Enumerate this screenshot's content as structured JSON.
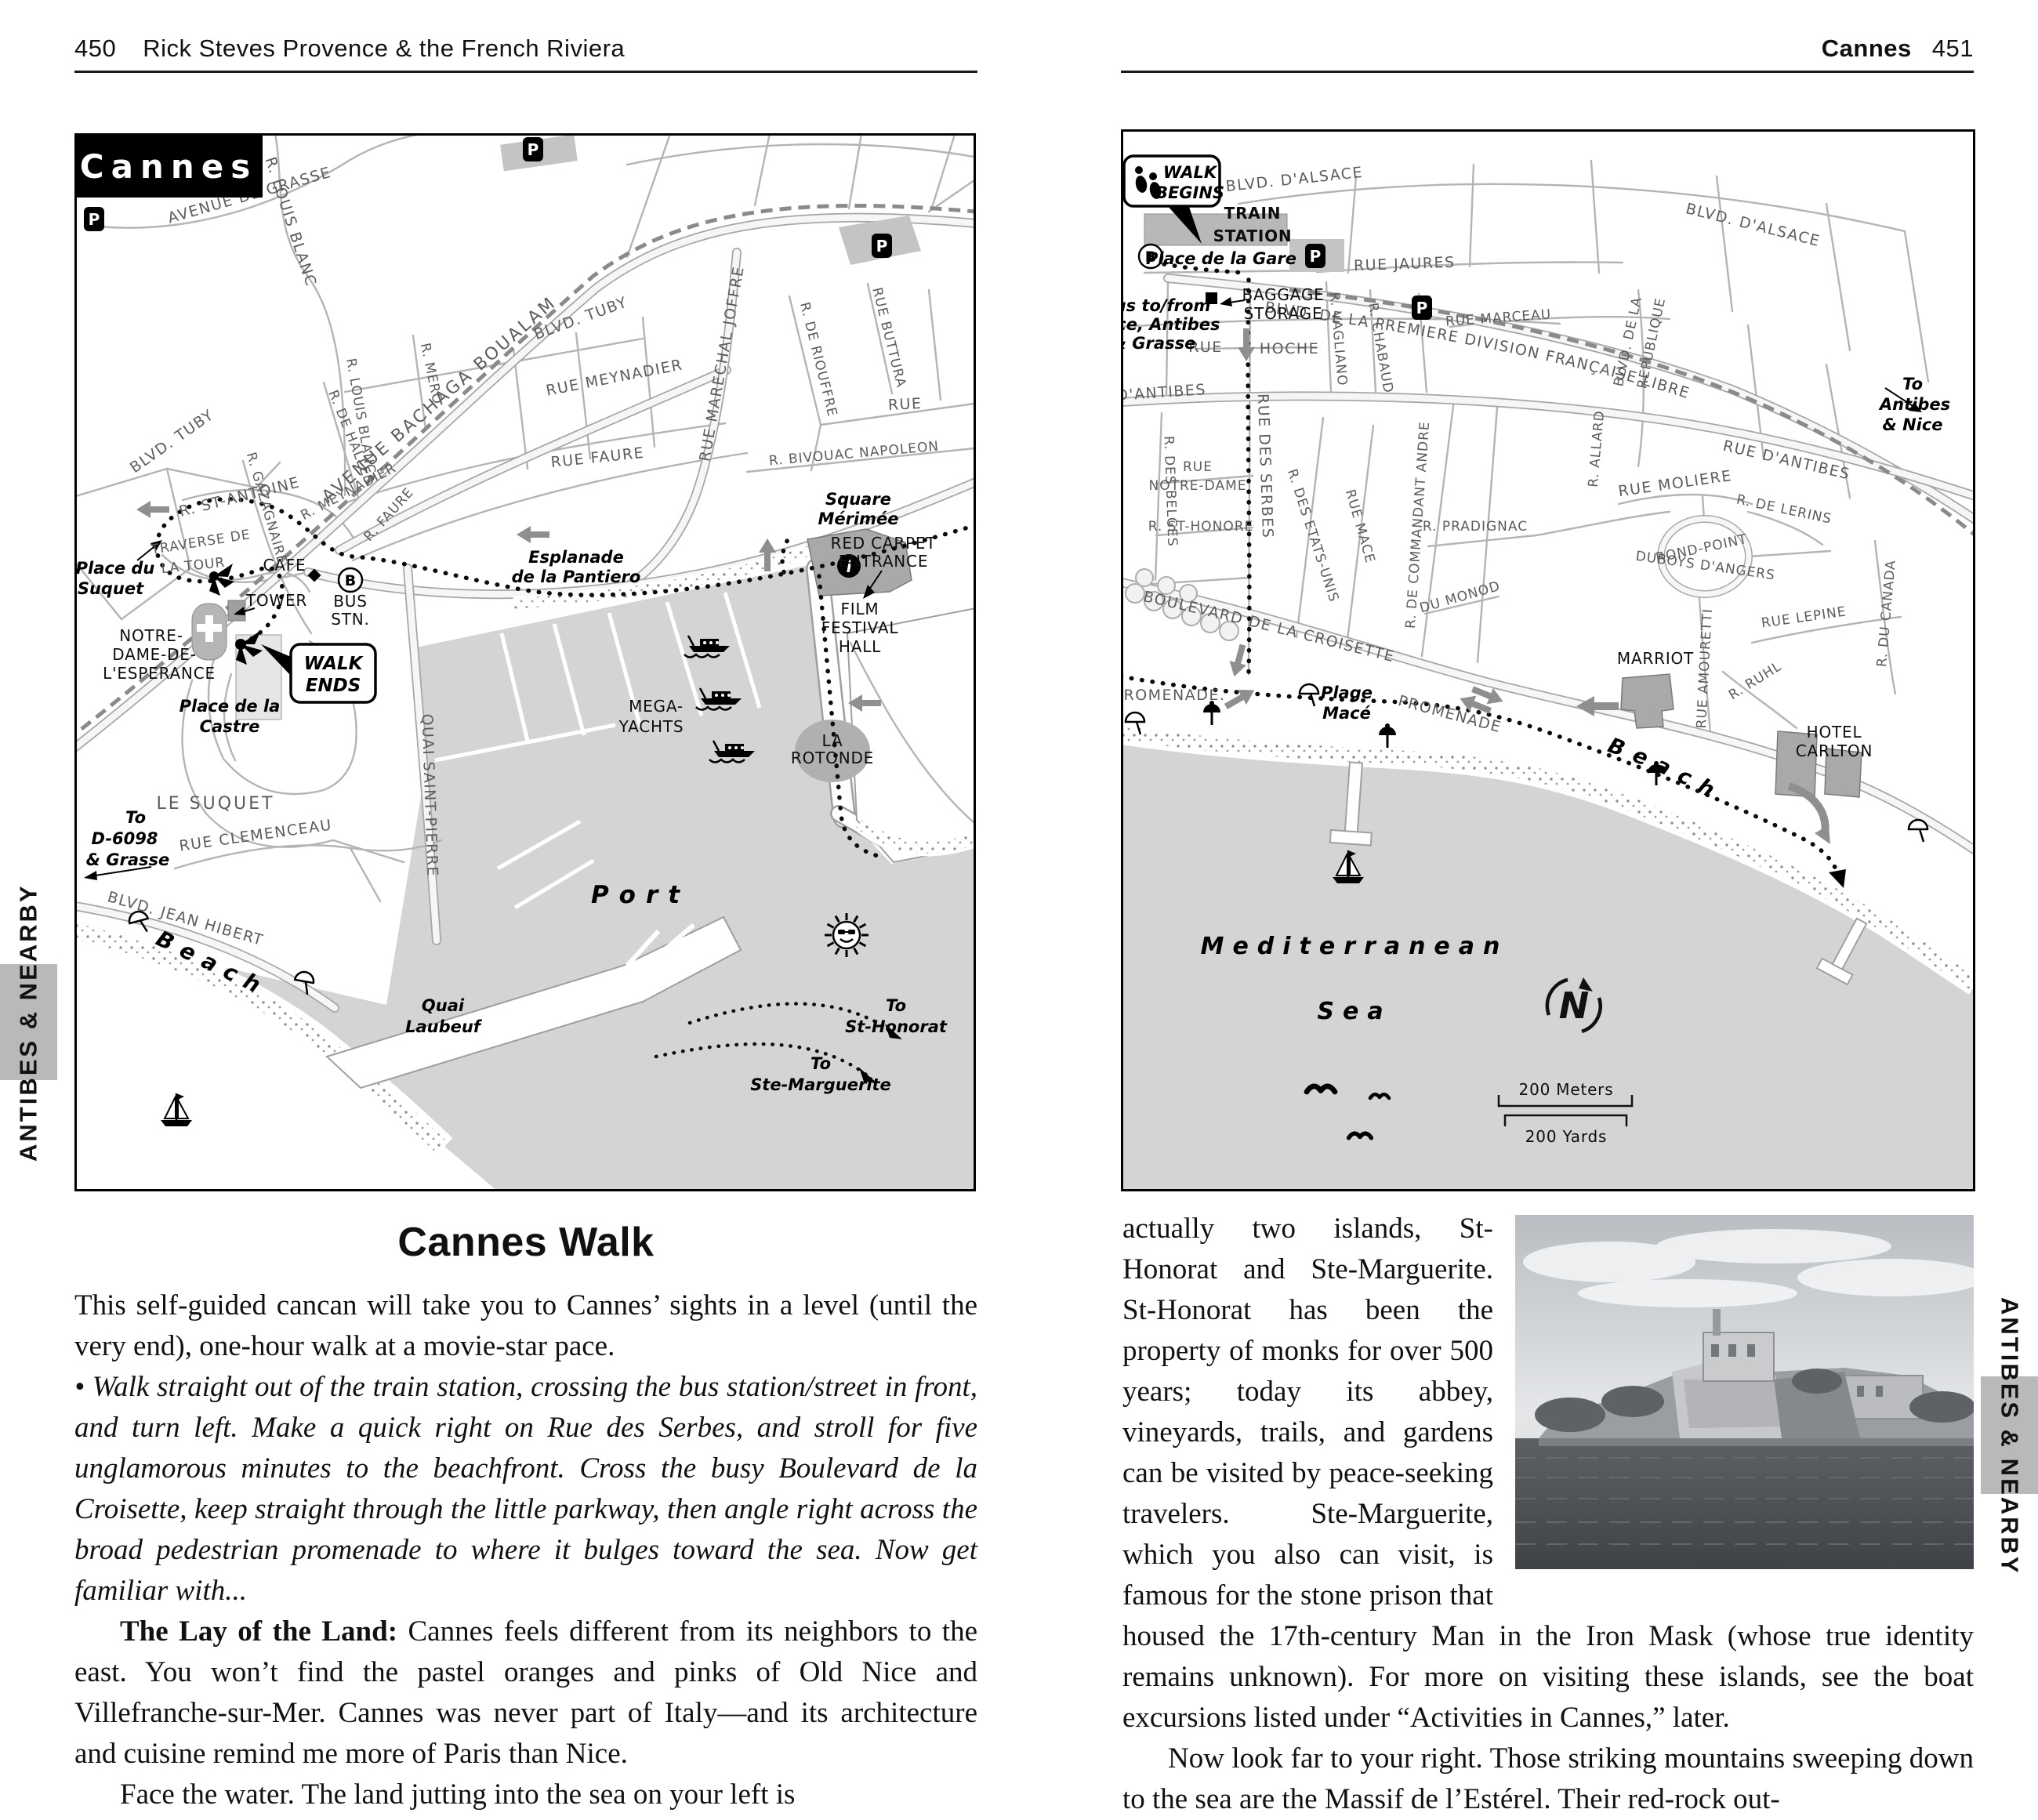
{
  "header_left": {
    "page_number": "450",
    "title": "Rick Steves Provence & the French Riviera"
  },
  "header_right": {
    "title": "Cannes",
    "page_number": "451"
  },
  "edge_tab": {
    "label": "ANTIBES & NEARBY"
  },
  "icons": {
    "parking": "P",
    "bus_stop": "B",
    "information": "i",
    "compass_north": "N"
  },
  "left_map": {
    "title": "Cannes",
    "streets": {
      "louis_blanc_upper": "R. LOUIS BLANC",
      "avenue_de_grasse": "AVENUE DE GRASSE",
      "avenue_bachaga": "AVENUE BACHAGA BOUALAM",
      "blvd_tuby_right": "BLVD. TUBY",
      "blvd_tuby_left": "BLVD. TUBY",
      "r_de_halles": "R. DE HALLES",
      "r_mero": "R. MERO",
      "rue_meynadier": "RUE MEYNADIER",
      "r_meynadier": "R. MEYNADIER",
      "r_gazagnaire": "R. GAZAGNAIRE",
      "louis_blanc_lower": "R. LOUIS BLANC",
      "rue_faure": "RUE FAURE",
      "r_faure": "R. FAURE",
      "rue_marechal_joffre": "RUE MARECHAL JOFFRE",
      "r_de_riouffre": "R. DE RIOUFFRE",
      "rue_buttura": "RUE BUTTURA",
      "rue": "RUE",
      "r_bivouac_napoleon": "R. BIVOUAC NAPOLEON",
      "r_st_antoine": "R. ST-ANTOINE",
      "traverse": [
        "TRAVERSE DE",
        "LA TOUR"
      ],
      "quai_saint_pierre": "QUAI SAINT-PIERRE",
      "rue_clemenceau": "RUE CLEMENCEAU",
      "blvd_jean_hibert": "BLVD. JEAN HIBERT",
      "le_suquet": "LE SUQUET"
    },
    "pois": {
      "cafe": "CAFE",
      "bus_stn": [
        "BUS",
        "STN."
      ],
      "tower": "TOWER",
      "notre_dame": [
        "NOTRE-",
        "DAME-DE-",
        "L'ESPERANCE"
      ],
      "red_carpet": [
        "RED CARPET",
        "ENTRANCE"
      ],
      "film_festival": [
        "FILM",
        "FESTIVAL",
        "HALL"
      ],
      "mega_yachts": [
        "MEGA-",
        "YACHTS"
      ],
      "la_rotonde": [
        "LA",
        "ROTONDE"
      ],
      "walk_ends": [
        "WALK",
        "ENDS"
      ]
    },
    "places": {
      "place_du_suquet": [
        "Place du",
        "Suquet"
      ],
      "place_de_la_castre": [
        "Place de la",
        "Castre"
      ],
      "esplanade": [
        "Esplanade",
        "de la Pantiero"
      ],
      "square_merimee": [
        "Square",
        "Mérimée"
      ],
      "quai_laubeuf": [
        "Quai",
        "Laubeuf"
      ],
      "port": "Port",
      "beach": "Beach",
      "to_d6098": [
        "To",
        "D-6098",
        "& Grasse"
      ],
      "to_st_honorat": [
        "To",
        "St-Honorat"
      ],
      "to_ste_marguerite": [
        "To",
        "Ste-Marguerite"
      ]
    }
  },
  "right_map": {
    "walk_begins": [
      "WALK",
      "BEGINS"
    ],
    "train_station": [
      "TRAIN",
      "STATION"
    ],
    "streets": {
      "blvd_alsace_left": "BLVD. D'ALSACE",
      "blvd_alsace_right": "BLVD. D'ALSACE",
      "blvd_premiere": "BLVD. DE LA PREMIERE DIVISION FRANÇAISE LIBRE",
      "rue_jaures": "RUE JAURES",
      "rue_marceau": "RUE MARCEAU",
      "rue_hoche": [
        "RUE",
        "HOCHE"
      ],
      "r_vagliano": "R. VAGLIANO",
      "r_chabaud": "R. CHABAUD",
      "blvd_republique": [
        "BLVD. DE LA",
        "REPUBLIQUE"
      ],
      "d_antibes": "D'ANTIBES",
      "rue_des_serbes": "RUE DES SERBES",
      "r_des_belges": "R. DES BELGES",
      "rue_notre_dame": [
        "RUE",
        "NOTRE-DAME"
      ],
      "r_st_honore": "R. ST-HONORE",
      "r_des_etats_unis": "R. DES ETATS-UNIS",
      "rue_mace": "RUE MACE",
      "r_commandant_andre": "R. DE COMMANDANT ANDRE",
      "r_pradignac": "R. PRADIGNAC",
      "du_monod": "DU MONOD",
      "croisette": "BOULEVARD DE LA CROISETTE",
      "promenade_left": "PROMENADE.",
      "promenade_right": "PROMENADE",
      "rue_amouretti": "RUE AMOURETTI",
      "r_ruhl": "R. RUHL",
      "rue_lepine": "RUE LEPINE",
      "rue_moliere": "RUE MOLIERE",
      "r_de_lerins": "R. DE LERINS",
      "rue_d_antibes": "RUE D'ANTIBES",
      "rond_point": [
        "ROND-POINT",
        "DUBOYS D'ANGERS"
      ],
      "r_du_canada": "R. DU CANADA",
      "r_allard": "R. ALLARD"
    },
    "pois": {
      "place_de_la_gare": "Place de la Gare",
      "bus_note": [
        "Bus to/from",
        "Nice, Antibes",
        "& Grasse"
      ],
      "baggage": [
        "BAGGAGE",
        "STORAGE"
      ],
      "marriot": "MARRIOT",
      "hotel_carlton": [
        "HOTEL",
        "CARLTON"
      ],
      "plage_mace": [
        "Plage",
        "Macé"
      ],
      "to_antibes": [
        "To",
        "Antibes",
        "& Nice"
      ],
      "beach": "Beach",
      "med_sea": [
        "Mediterranean",
        "Sea"
      ]
    },
    "scale": {
      "meters": "200 Meters",
      "yards": "200 Yards"
    }
  },
  "article": {
    "heading": "Cannes Walk",
    "p1": "This self-guided cancan will take you to Cannes’ sights in a level (until the very end), one-hour walk at a movie-star pace.",
    "p2": "• Walk straight out of the train station, crossing the bus station/street in front, and turn left. Make a quick right on Rue des Serbes, and stroll for five unglamorous minutes to the beachfront. Cross the busy Boulevard de la Croisette, keep straight through the little parkway, then angle right across the broad pedestrian promenade to where it bulges toward the sea. Now get familiar with...",
    "p3_lead": "The Lay of the Land:",
    "p3_rest": " Cannes feels different from its neighbors to the east. You won’t find the pastel oranges and pinks of Old Nice and Villefranche-sur-Mer. Cannes was never part of Italy—and its architecture and cuisine remind me more of Paris than Nice.",
    "p4": "Face the water. The land jutting into the sea on your left is",
    "p5": "actually two islands, St-Honorat and Ste-Marguerite. St-Honorat has been the property of monks for over 500 years; today its abbey, vineyards, trails, and gardens can be visited by peace-seeking travelers. Ste-Marguerite, which you also can visit, is famous for the stone prison that housed the 17th-century Man in the Iron Mask (whose true identity remains unknown). For more on visiting these islands, see the boat excursions listed under “Activities in Cannes,” later.",
    "p6": "Now look far to your right. Those striking mountains sweeping down to the sea are the Massif de l’Estérel. Their red-rock out-"
  }
}
